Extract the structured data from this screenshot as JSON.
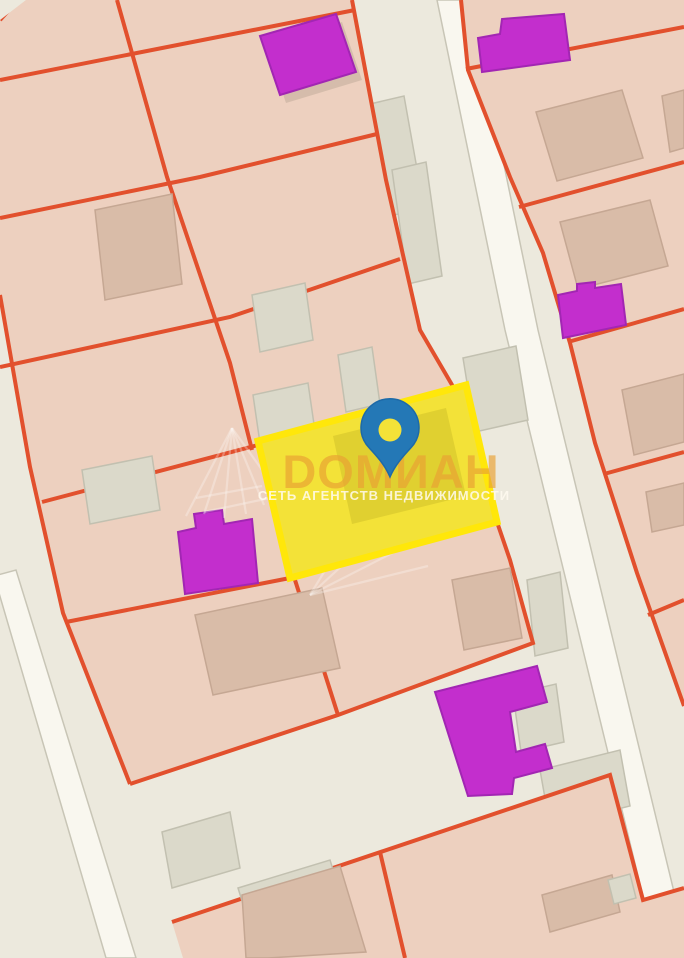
{
  "watermark": {
    "title": "DОМИАН",
    "subtitle": "СЕТЬ АГЕНТСТВ НЕДВИЖИМОСТИ"
  },
  "map": {
    "kind": "cadastral parcel map with selected lot highlighted",
    "colors": {
      "bg": "#ece9dd",
      "roadStripe": "#f9f7ef",
      "roadStripeEdge": "#c8c5b6",
      "parcel": "#edd0bf",
      "border": "#e2502d",
      "bldgSalmon": "#d9bca8",
      "bldgSalmonEdge": "#c5a793",
      "bldgGray": "#dbd9ca",
      "bldgGrayEdge": "#c2c0b0",
      "purple": "#c32ecd",
      "purpleEdge": "#a226b3",
      "selectedFill": "#f3e238",
      "selectedEdge": "#ffe70a",
      "selectedBldg": "#cdbd28",
      "pin": "#2478b6",
      "pinEdge": "#1d6aa8",
      "wmTitle": "#e8a133aa",
      "wmSubtitle": "#fffaf0d9",
      "wmMark": "#ffffff55"
    }
  }
}
